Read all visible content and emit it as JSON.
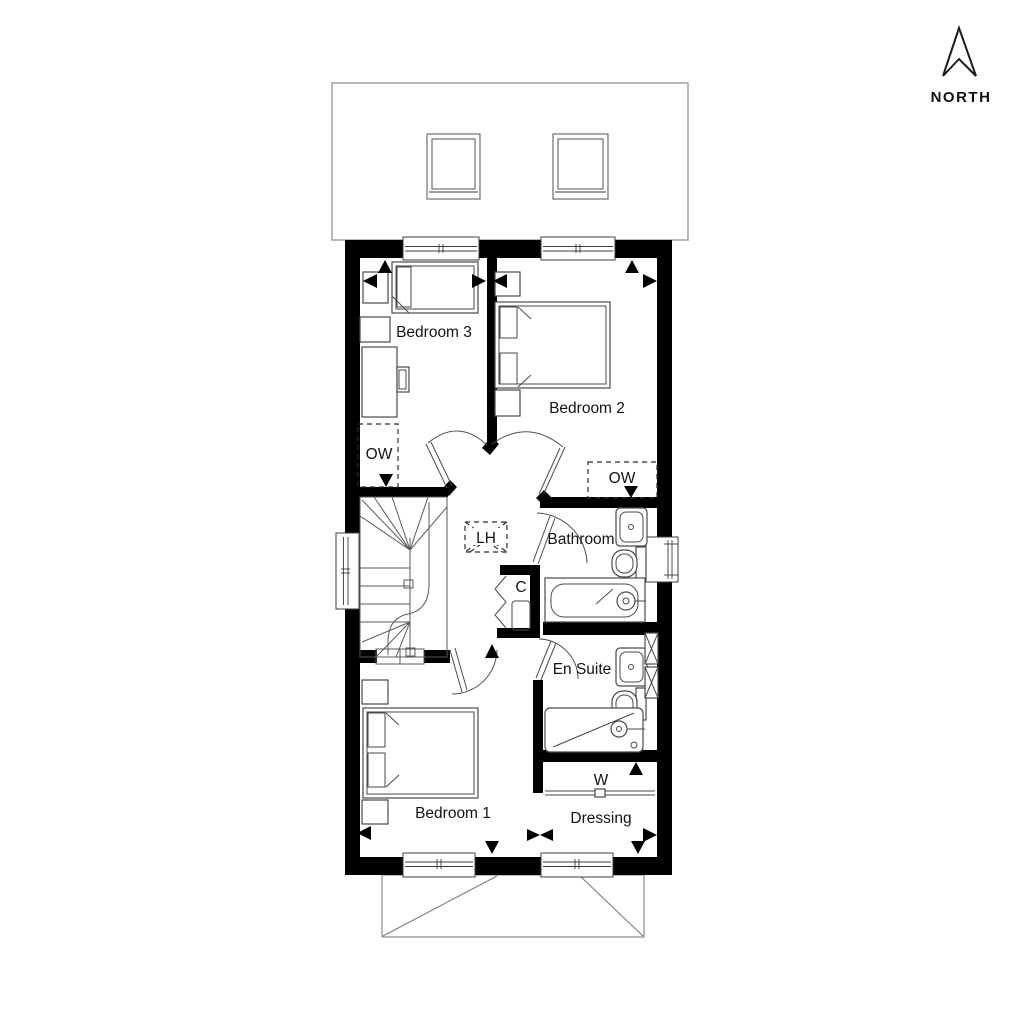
{
  "compass": {
    "label": "NORTH"
  },
  "rooms": [
    {
      "id": "bedroom-3",
      "label": "Bedroom 3"
    },
    {
      "id": "bedroom-2",
      "label": "Bedroom 2"
    },
    {
      "id": "bathroom",
      "label": "Bathroom"
    },
    {
      "id": "en-suite",
      "label": "En Suite"
    },
    {
      "id": "bedroom-1",
      "label": "Bedroom 1"
    },
    {
      "id": "dressing",
      "label": "Dressing"
    }
  ],
  "annotations": [
    {
      "id": "obscure-window-bedroom-3",
      "label": "OW"
    },
    {
      "id": "obscure-window-bathroom",
      "label": "OW"
    },
    {
      "id": "loft-hatch",
      "label": "LH"
    },
    {
      "id": "cupboard",
      "label": "C"
    },
    {
      "id": "wardrobe",
      "label": "W"
    }
  ],
  "colors": {
    "walls": "#000000",
    "detail_lines": "#4a4a4a",
    "roof_outline": "#9a9a9a",
    "background": "#ffffff"
  }
}
